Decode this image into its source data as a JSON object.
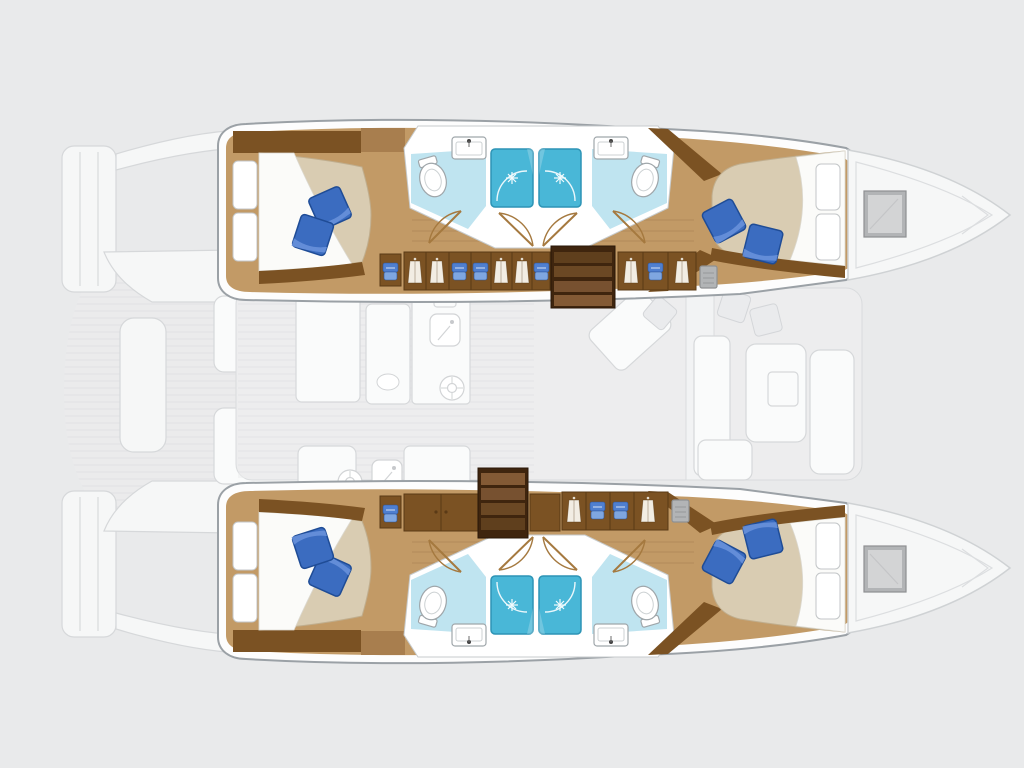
{
  "diagram": {
    "type": "catamaran-interior-layout-floorplan",
    "orientation": "bows-right",
    "style": "top-down boat plan: colored lower-deck hull interiors over a ghosted main-deck plan",
    "hulls": [
      {
        "name": "top hull",
        "rooms": [
          {
            "name": "aft double cabin",
            "items": [
              "island bed",
              "2 white head pillows",
              "2 blue accent cushions",
              "white duvet",
              "wardrobe cabinetry"
            ]
          },
          {
            "name": "aft bathroom",
            "items": [
              "toilet",
              "washbasin",
              "shower stall"
            ]
          },
          {
            "name": "forward bathroom",
            "items": [
              "toilet",
              "washbasin",
              "shower stall"
            ]
          },
          {
            "name": "forward double cabin",
            "items": [
              "island bed",
              "2 white head pillows",
              "2 blue accent cushions",
              "white duvet"
            ]
          }
        ],
        "passage": [
          "companionway stairs",
          "hanging-locker wardrobes",
          "folded-linen shelves",
          "door swing arcs"
        ],
        "bow": [
          "ghosted bow deck",
          "gray deck hatch"
        ]
      },
      {
        "name": "bottom hull",
        "rooms": [
          {
            "name": "aft double cabin",
            "items": [
              "island bed",
              "2 white head pillows",
              "2 blue accent cushions",
              "white duvet",
              "wardrobe cabinetry"
            ]
          },
          {
            "name": "aft bathroom",
            "items": [
              "toilet",
              "washbasin",
              "shower stall"
            ]
          },
          {
            "name": "forward bathroom",
            "items": [
              "toilet",
              "washbasin",
              "shower stall"
            ]
          },
          {
            "name": "forward double cabin",
            "items": [
              "island bed",
              "2 white head pillows",
              "2 blue accent cushions",
              "white duvet"
            ]
          }
        ],
        "passage": [
          "companionway stairs",
          "hanging-locker wardrobes",
          "folded-linen shelves",
          "door swing arcs"
        ],
        "bow": [
          "ghosted bow deck",
          "gray deck hatch"
        ]
      }
    ],
    "ghosted_main_deck": {
      "aft": [
        "swim platforms",
        "transom steps",
        "teak cockpit floor",
        "cockpit benches",
        "cockpit table"
      ],
      "saloon": [
        "galley counters",
        "2 galley sinks",
        "2 stove burners",
        "dinette table",
        "sofas",
        "scatter cushions",
        "companionway walkway"
      ]
    }
  },
  "palette": {
    "background": "#e9eaeb",
    "hull_outline": "#9ba1a6",
    "hull_wall": "#fdfdfd",
    "floor_wood": "#c29a66",
    "cabinet_wood": "#7b5223",
    "cabinet_wood_light": "#a87e4e",
    "cabinet_wood_dark": "#5a3a16",
    "stair_dark": "#3f250e",
    "mattress": "#d9ccb2",
    "mattress_edge": "#c0ae8e",
    "duvet": "#fbfbf9",
    "pillow_white": "#ffffff",
    "pillow_blue": "#3b6cc0",
    "pillow_blue_light": "#6b93dc",
    "pillow_blue_dark": "#1f4c96",
    "bath_floor_blue": "#bfe4f0",
    "shower_blue": "#49b7d7",
    "shower_blue_dark": "#2d94b5",
    "fixture_outline": "#9fa6aa",
    "hatch_gray": "#b2b4b6",
    "hatch_gray_light": "#d8d9da",
    "ghost_fill": "#f6f7f7",
    "ghost_line": "#d6d8da",
    "door_wood": "#a5793f"
  }
}
